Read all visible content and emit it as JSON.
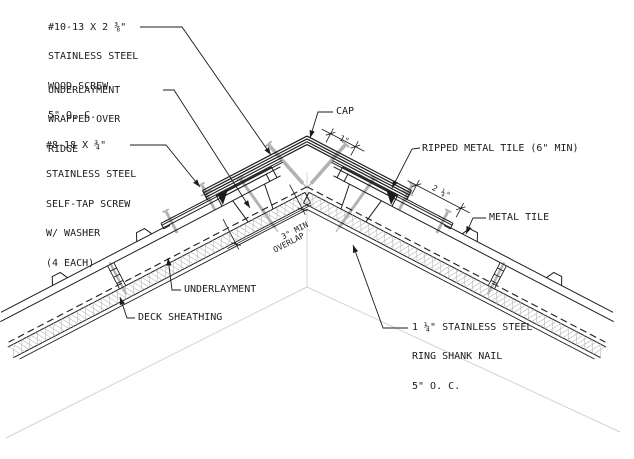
{
  "drawing_title": "roof-ridge-metal-tile-detail",
  "colors": {
    "line": "#1c1c1c",
    "screw_gray": "#b2b2b2",
    "faint": "#d4d4d4",
    "hatch": "#b8b8b8",
    "background": "#ffffff"
  },
  "labels": {
    "wood_screw": {
      "lines": [
        "#10-13 X 2 ⅜\"",
        "STAINLESS STEEL",
        "WOOD SCREW",
        "5\" O. C."
      ]
    },
    "underlayment_ridge": {
      "lines": [
        "UNDERLAYMENT",
        "WRAPPED OVER",
        "RIDGE"
      ]
    },
    "self_tap_screw": {
      "lines": [
        "#8-18 X ¾\"",
        "STAINLESS STEEL",
        "SELF-TAP SCREW",
        "W/ WASHER",
        "(4 EACH)"
      ]
    },
    "cap": "CAP",
    "ripped_metal_tile": "RIPPED METAL TILE (6\" MIN)",
    "metal_tile": "METAL TILE",
    "underlayment": "UNDERLAYMENT",
    "deck_sheathing": "DECK SHEATHING",
    "ring_shank_nail": {
      "lines": [
        "1 ¼\" STAINLESS STEEL",
        "RING SHANK NAIL",
        "5\" O. C."
      ]
    }
  },
  "dimensions": {
    "cap_edge": "1\"",
    "ripped_tile_exposure": "2 ¼\"",
    "overlap": {
      "lines": [
        "3\" MIN",
        "OVERLAP"
      ]
    }
  }
}
